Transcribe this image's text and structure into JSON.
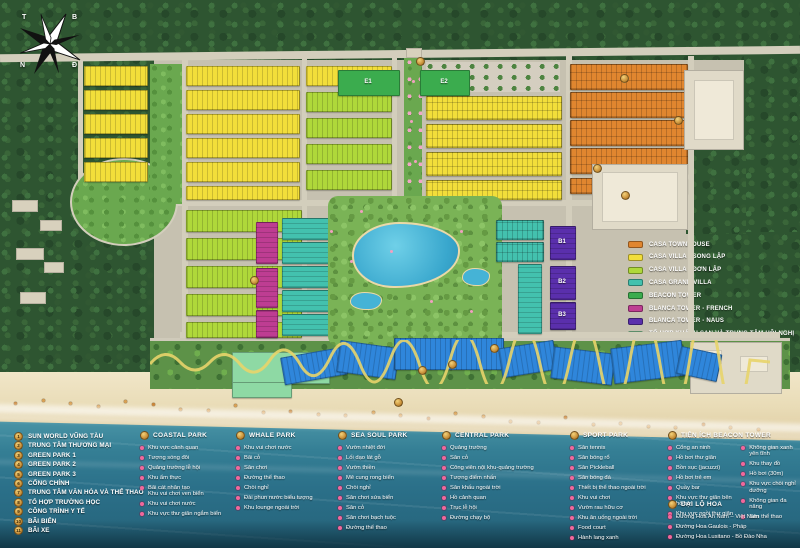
{
  "compass": {
    "west": "T",
    "north": "B",
    "south": "N",
    "east": "Đ"
  },
  "map_labels": {
    "e1": "E1",
    "e2": "E2",
    "b1": "B1",
    "b2": "B2",
    "b3": "B3"
  },
  "colors": {
    "casa_townhouse": "#E0862F",
    "casa_villa_song_lap": "#F2DE3A",
    "casa_villa_don_lap": "#AFD83A",
    "casa_grand_villa": "#43C1AE",
    "beacon_tower": "#3BAC4E",
    "blanca_french": "#BE3D92",
    "blanca_naus": "#5A2FAC",
    "hotel_conference": "#8ED9A4",
    "commercial": "#2F86DB",
    "badge_gold": "#C9913A",
    "bullet_pink": "#F2679B"
  },
  "legend": {
    "items": [
      {
        "label": "CASA TOWNHOUSE",
        "color": "#E0862F"
      },
      {
        "label": "CASA VILLA - SONG LẬP",
        "color": "#F2DE3A"
      },
      {
        "label": "CASA VILLA - ĐƠN LẬP",
        "color": "#AFD83A"
      },
      {
        "label": "CASA GRAND VILLA",
        "color": "#43C1AE"
      },
      {
        "label": "BEACON TOWER",
        "color": "#3BAC4E"
      },
      {
        "label": "BLANCA TOWER - FRENCH",
        "color": "#BE3D92"
      },
      {
        "label": "BLANCA TOWER - NAUS",
        "color": "#5A2FAC"
      },
      {
        "label": "TỔ HỢP KHÁCH SẠN VÀ TRUNG TÂM HỘI NGHỊ",
        "color": "#8ED9A4"
      },
      {
        "label": "TRUNG TÂM THƯƠNG MẠI",
        "color": "#2F86DB"
      }
    ]
  },
  "numbered_legend": {
    "items": [
      {
        "num": "1",
        "label": "SUN WORLD VŨNG TÀU"
      },
      {
        "num": "2",
        "label": "TRUNG TÂM THƯƠNG MẠI"
      },
      {
        "num": "3",
        "label": "GREEN PARK 1"
      },
      {
        "num": "4",
        "label": "GREEN PARK 2"
      },
      {
        "num": "5",
        "label": "GREEN PARK 3"
      },
      {
        "num": "6",
        "label": "CỔNG CHÍNH"
      },
      {
        "num": "7",
        "label": "TRUNG TÂM VĂN HÓA VÀ THỂ THAO"
      },
      {
        "num": "8",
        "label": "TỔ HỢP TRƯỜNG HỌC"
      },
      {
        "num": "9",
        "label": "CÔNG TRÌNH Y TẾ"
      },
      {
        "num": "10",
        "label": "BÃI BIỂN"
      },
      {
        "num": "11",
        "label": "BÃI XE"
      }
    ]
  },
  "park_sections": [
    {
      "title": "COASTAL PARK",
      "columns": [
        [
          "Khu vực cảnh quan",
          "Tượng sóng đôi",
          "Quảng trường lễ hội",
          "Khu ẩm thực",
          "Bãi cát nhân tạo\nKhu vui chơi ven biển",
          "Khu vui chơi nước",
          "Khu vực thư giãn ngắm biển"
        ]
      ]
    },
    {
      "title": "WHALE PARK",
      "columns": [
        [
          "Khu vui chơi nước",
          "Bãi cỏ",
          "Sân chơi",
          "Đường thể thao",
          "Chòi nghỉ",
          "Đài phun nước biểu tượng",
          "Khu lounge ngoài trời"
        ]
      ]
    },
    {
      "title": "SEA SOUL PARK",
      "columns": [
        [
          "Vườn nhiệt đới",
          "Lối dạo lát gỗ",
          "Vườn thiền",
          "Mê cung rong biển",
          "Chòi nghỉ",
          "Sân chơi sứa biển",
          "Sân cỏ",
          "Sân chơi bạch tuộc",
          "Đường thể thao"
        ]
      ]
    },
    {
      "title": "CENTRAL PARK",
      "columns": [
        [
          "Quảng trường",
          "Sân cỏ",
          "Công viên nội khu-quảng trường",
          "Tượng điểm nhấn",
          "Sân khấu ngoài trời",
          "Hồ cảnh quan",
          "Trục lễ hội",
          "Đường chạy bộ"
        ]
      ]
    },
    {
      "title": "SPORT PARK",
      "columns": [
        [
          "Sân tennis",
          "Sân bóng rổ",
          "Sân Pickleball",
          "Sân bóng đá",
          "Thiết bị thể thao ngoài trời",
          "Khu vui chơi",
          "Vườn rau hữu cơ",
          "Khu ăn uống ngoài trời",
          "Food court",
          "Hành lang xanh"
        ]
      ]
    },
    {
      "title": "TIỆN ÍCH BEACON TOWER",
      "columns": [
        [
          "Cổng an ninh",
          "Hồ bơi thư giãn",
          "Bồn sục (jacuzzi)",
          "Hồ bơi trẻ em",
          "Quầy bar",
          "Khu vực thư giãn bên hồ bơi",
          "Khu vực ngồi thư giãn"
        ],
        [
          "Không gian xanh yên tĩnh",
          "Khu thay đồ",
          "Hồ bơi (30m)",
          "Khu vực chòi nghỉ dưỡng",
          "Không gian đa năng",
          "Sân thể thao"
        ]
      ]
    },
    {
      "title": "ĐẠI LỘ HOA",
      "columns": [
        [
          "Đường Hoa An Nam – Việt Nam",
          "Đường Hoa Gaulois - Pháp",
          "Đường Hoa Lusitano - Bồ Đào Nha"
        ]
      ]
    }
  ]
}
